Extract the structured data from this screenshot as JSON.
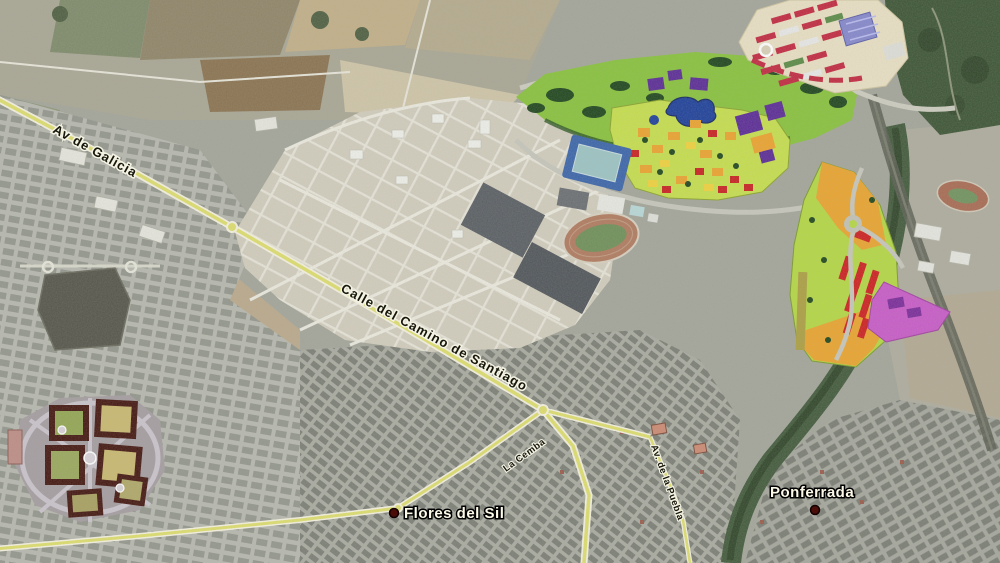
{
  "map": {
    "street_labels": {
      "av_galicia": "Av de Galicia",
      "camino_santiago": "Calle del Camino de Santiago",
      "av_puebla": "Av. de la Puebla",
      "la_cemba": "La Cemba"
    },
    "place_labels": {
      "flores_del_sil": "Flores del Sil",
      "ponferrada": "Ponferrada"
    },
    "markers": {
      "flores_del_sil": {
        "color": "#4a0d08"
      },
      "ponferrada": {
        "color": "#4a0d08"
      }
    },
    "palette": {
      "road_yellow": "#dede6e",
      "park_green": "#88c23c",
      "development_lime": "#c6df4d",
      "zone_lime": "#b4d844",
      "zone_orange": "#eaa42e",
      "zone_yellow": "#f0d23c",
      "zone_red": "#cd1f1f",
      "zone_purple": "#5a2a96",
      "zone_magenta": "#c85ac8",
      "lake_blue": "#1d3f9a",
      "stadium_blue": "#3a64aa",
      "block_maroon": "#43150f",
      "row_crimson": "#c22840",
      "river_green": "#41593a",
      "cream_site": "#e9e0c4"
    }
  }
}
